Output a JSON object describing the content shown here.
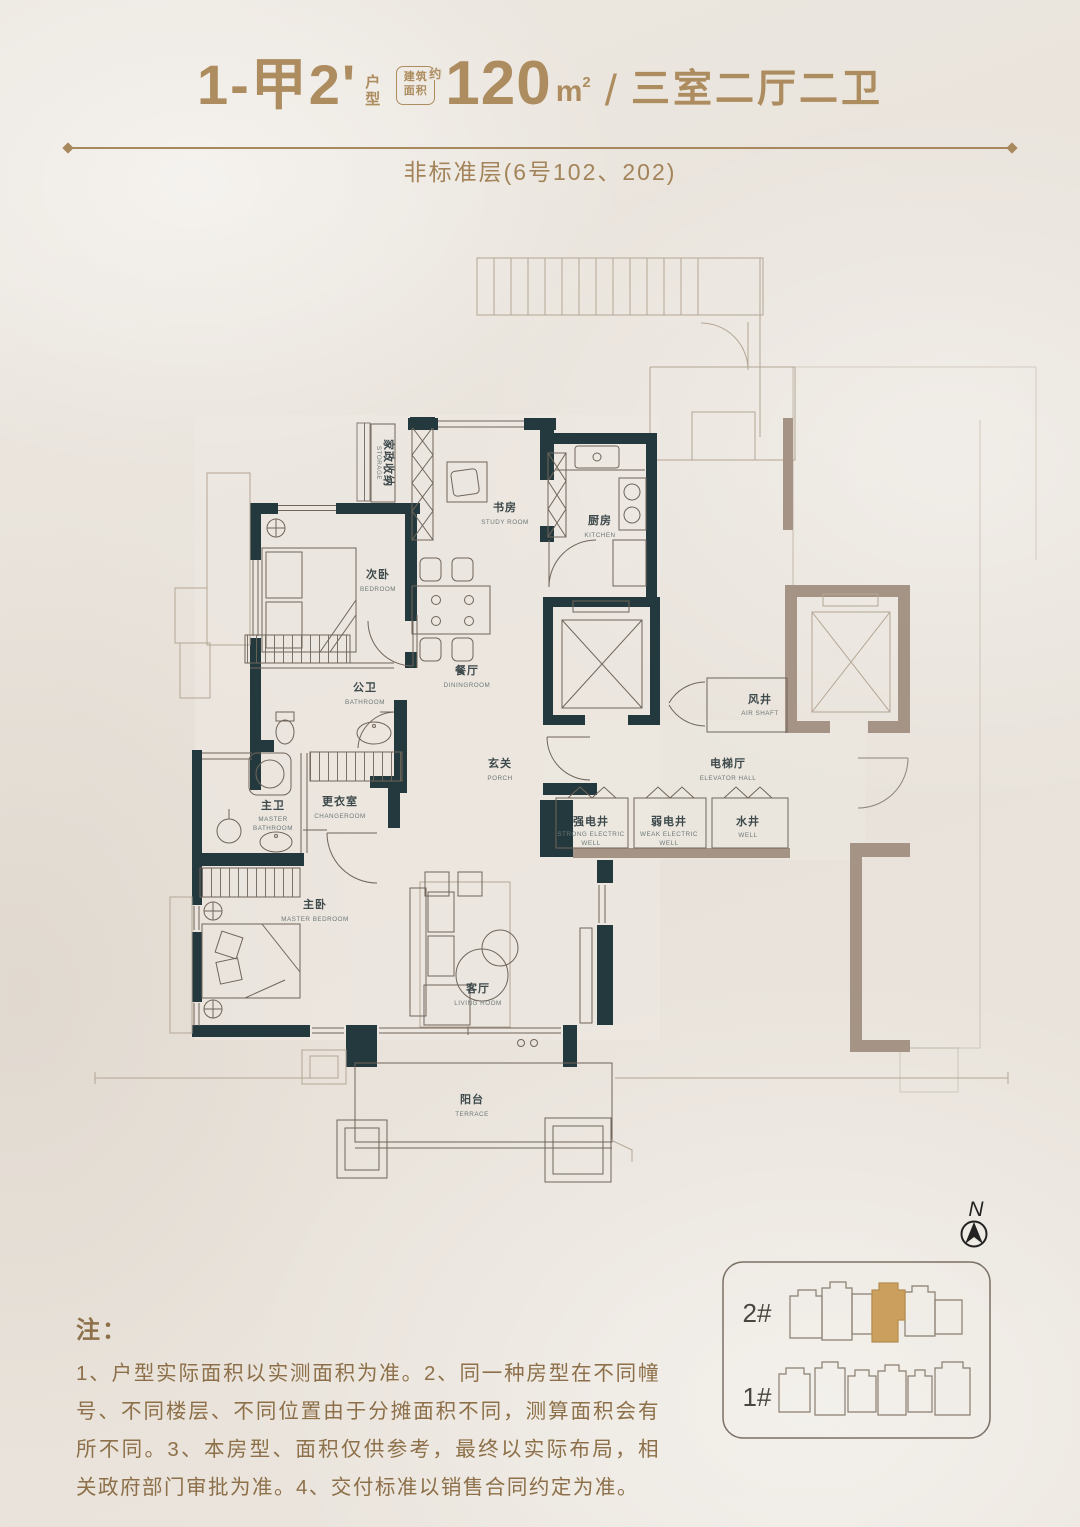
{
  "page": {
    "bg": "#e9e4dd",
    "accent_gold": "#ad8d60",
    "wall_dark": "#24393d",
    "wall_taupe": "#a59486",
    "site_highlight": "#cb9f5e"
  },
  "header": {
    "unit_code": "1-甲2'",
    "unit_suffix_1": "户",
    "unit_suffix_2": "型",
    "area_badge_line1": "建筑",
    "area_badge_line2": "面积",
    "area_badge_approx": "约",
    "area_value": "120",
    "area_unit_base": "m",
    "area_unit_sup": "2",
    "separator": "/",
    "layout_desc": "三室二厅二卫",
    "subtitle": "非标准层(6号102、202)"
  },
  "rooms": {
    "bedroom2": {
      "cn": "次卧",
      "en": "BEDROOM"
    },
    "study": {
      "cn": "书房",
      "en": "STUDY ROOM"
    },
    "kitchen": {
      "cn": "厨房",
      "en": "KITCHEN"
    },
    "dining": {
      "cn": "餐厅",
      "en": "DININGROOM"
    },
    "public_bath": {
      "cn": "公卫",
      "en": "BATHROOM"
    },
    "porch": {
      "cn": "玄关",
      "en": "PORCH"
    },
    "air_shaft": {
      "cn": "风井",
      "en": "AIR SHAFT"
    },
    "elevator_hall": {
      "cn": "电梯厅",
      "en": "ELEVATOR HALL"
    },
    "strong_electric_well": {
      "cn": "强电井",
      "en1": "STRONG ELECTRIC",
      "en2": "WELL"
    },
    "weak_electric_well": {
      "cn": "弱电井",
      "en1": "WEAK ELECTRIC",
      "en2": "WELL"
    },
    "water_well": {
      "cn": "水井",
      "en": "WELL"
    },
    "master_bath": {
      "cn": "主卫",
      "en1": "MASTER",
      "en2": "BATHROOM"
    },
    "changeroom": {
      "cn": "更衣室",
      "en": "CHANGEROOM"
    },
    "master_bedroom": {
      "cn": "主卧",
      "en": "MASTER BEDROOM"
    },
    "living": {
      "cn": "客厅",
      "en": "LIVING ROOM"
    },
    "terrace": {
      "cn": "阳台",
      "en": "TERRACE"
    },
    "storage_niche": {
      "cn": "家政收纳",
      "en": "STORAGE"
    }
  },
  "site_plan": {
    "building_2": "2#",
    "building_1": "1#",
    "compass_n": "N"
  },
  "notes": {
    "title": "注：",
    "body": "1、户型实际面积以实测面积为准。2、同一种房型在不同幢号、不同楼层、不同位置由于分摊面积不同，测算面积会有所不同。3、本房型、面积仅供参考，最终以实际布局，相关政府部门审批为准。4、交付标准以销售合同约定为准。"
  }
}
